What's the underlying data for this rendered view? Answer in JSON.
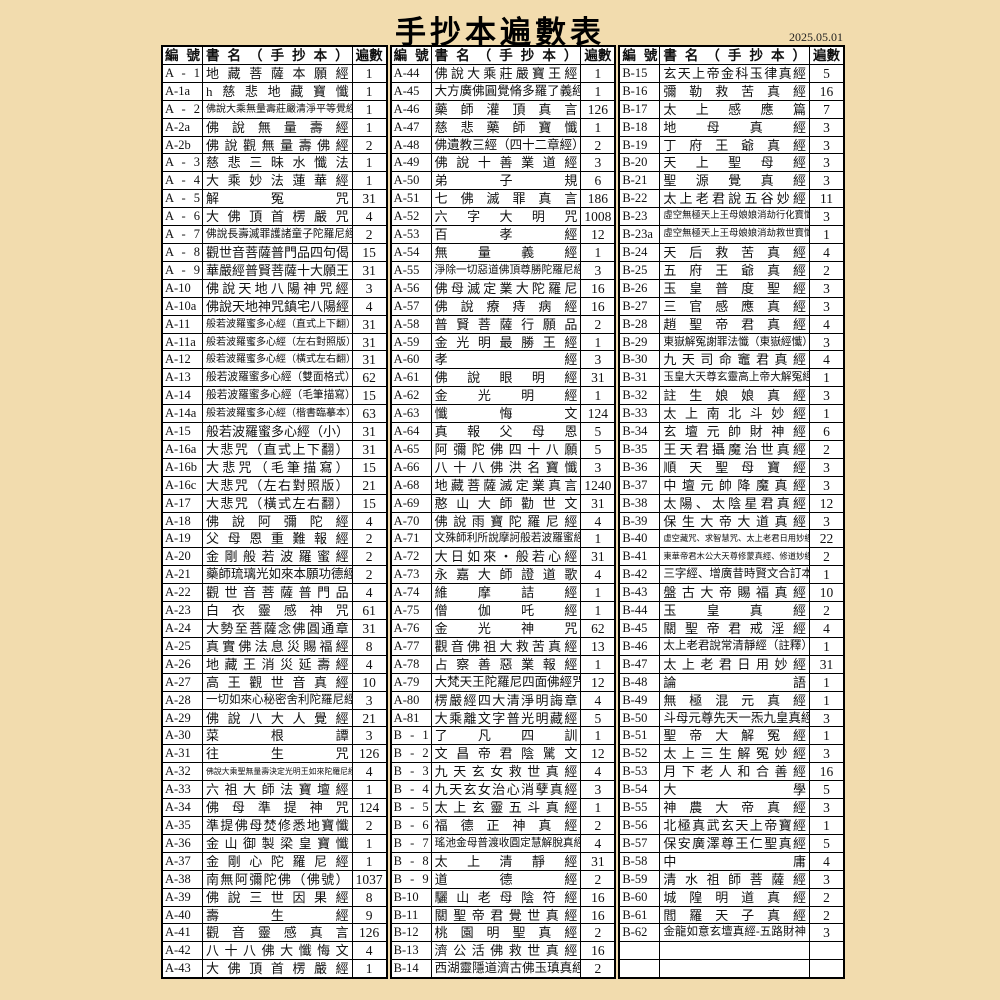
{
  "title": "手抄本遍數表",
  "date": "2025.05.01",
  "colors": {
    "background": "#f2dcae",
    "cell": "#ffffff",
    "border": "#000000",
    "text": "#111111"
  },
  "table": {
    "header": {
      "id": "編號",
      "title": "書名（手抄本）",
      "count": "遍數"
    },
    "columns": [
      {
        "rows": [
          {
            "id": "A - 1",
            "title": "地藏菩薩本願經",
            "count": "1"
          },
          {
            "id": "A-1a",
            "title": "h慈悲地藏寶懺",
            "count": "1"
          },
          {
            "id": "A - 2",
            "title": "佛說大乘無量壽莊嚴清淨平等覺經",
            "count": "1"
          },
          {
            "id": "A-2a",
            "title": "佛說無量壽經",
            "count": "1"
          },
          {
            "id": "A-2b",
            "title": "佛說觀無量壽佛經",
            "count": "2"
          },
          {
            "id": "A - 3",
            "title": "慈悲三昧水懺法",
            "count": "1"
          },
          {
            "id": "A - 4",
            "title": "大乘妙法蓮華經",
            "count": "1"
          },
          {
            "id": "A - 5",
            "title": "解冤咒",
            "count": "31"
          },
          {
            "id": "A - 6",
            "title": "大佛頂首楞嚴咒",
            "count": "4"
          },
          {
            "id": "A - 7",
            "title": "佛說長壽滅罪護諸童子陀羅尼經",
            "count": "2"
          },
          {
            "id": "A - 8",
            "title": "觀世音菩薩普門品四句偈",
            "count": "15"
          },
          {
            "id": "A - 9",
            "title": "華嚴經普賢菩薩十大願王",
            "count": "31"
          },
          {
            "id": "A-10",
            "title": "佛說天地八陽神咒經",
            "count": "3"
          },
          {
            "id": "A-10a",
            "title": "佛說天地神咒鎮宅八陽經",
            "count": "4"
          },
          {
            "id": "A-11",
            "title": "般若波羅蜜多心經（直式上下翻）",
            "count": "31"
          },
          {
            "id": "A-11a",
            "title": "般若波羅蜜多心經（左右對照版）",
            "count": "31"
          },
          {
            "id": "A-12",
            "title": "般若波羅蜜多心經（橫式左右翻）",
            "count": "31"
          },
          {
            "id": "A-13",
            "title": "般若波羅蜜多心經（雙面格式）",
            "count": "62"
          },
          {
            "id": "A-14",
            "title": "般若波羅蜜多心經（毛筆描寫）",
            "count": "15"
          },
          {
            "id": "A-14a",
            "title": "般若波羅蜜多心經（楷書臨摹本）",
            "count": "63"
          },
          {
            "id": "A-15",
            "title": "般若波羅蜜多心經（小）",
            "count": "31"
          },
          {
            "id": "A-16a",
            "title": "大悲咒（直式上下翻）",
            "count": "31"
          },
          {
            "id": "A-16b",
            "title": "大悲咒（毛筆描寫）",
            "count": "15"
          },
          {
            "id": "A-16c",
            "title": "大悲咒（左右對照版）",
            "count": "21"
          },
          {
            "id": "A-17",
            "title": "大悲咒（橫式左右翻）",
            "count": "15"
          },
          {
            "id": "A-18",
            "title": "佛說阿彌陀經",
            "count": "4"
          },
          {
            "id": "A-19",
            "title": "父母恩重難報經",
            "count": "2"
          },
          {
            "id": "A-20",
            "title": "金剛般若波羅蜜經",
            "count": "2"
          },
          {
            "id": "A-21",
            "title": "藥師琉璃光如來本願功德經",
            "count": "2"
          },
          {
            "id": "A-22",
            "title": "觀世音菩薩普門品",
            "count": "4"
          },
          {
            "id": "A-23",
            "title": "白衣靈感神咒",
            "count": "61"
          },
          {
            "id": "A-24",
            "title": "大勢至菩薩念佛圓通章",
            "count": "31"
          },
          {
            "id": "A-25",
            "title": "真實佛法息災賜福經",
            "count": "8"
          },
          {
            "id": "A-26",
            "title": "地藏王消災延壽經",
            "count": "4"
          },
          {
            "id": "A-27",
            "title": "高王觀世音真經",
            "count": "10"
          },
          {
            "id": "A-28",
            "title": "一切如來心秘密舍利陀羅尼經",
            "count": "3"
          },
          {
            "id": "A-29",
            "title": "佛說八大人覺經",
            "count": "21"
          },
          {
            "id": "A-30",
            "title": "菜根譚",
            "count": "3"
          },
          {
            "id": "A-31",
            "title": "往生咒",
            "count": "126"
          },
          {
            "id": "A-32",
            "title": "佛說大乘聖無量壽決定光明王如來陀羅尼經",
            "count": "4"
          },
          {
            "id": "A-33",
            "title": "六祖大師法寶壇經",
            "count": "1"
          },
          {
            "id": "A-34",
            "title": "佛母準提神咒",
            "count": "124"
          },
          {
            "id": "A-35",
            "title": "準提佛母焚修悉地寶懺",
            "count": "2"
          },
          {
            "id": "A-36",
            "title": "金山御製梁皇寶懺",
            "count": "1"
          },
          {
            "id": "A-37",
            "title": "金剛心陀羅尼經",
            "count": "1"
          },
          {
            "id": "A-38",
            "title": "南無阿彌陀佛（佛號）",
            "count": "1037"
          },
          {
            "id": "A-39",
            "title": "佛說三世因果經",
            "count": "8"
          },
          {
            "id": "A-40",
            "title": "壽生經",
            "count": "9"
          },
          {
            "id": "A-41",
            "title": "觀音靈感真言",
            "count": "126"
          },
          {
            "id": "A-42",
            "title": "八十八佛大懺悔文",
            "count": "4"
          },
          {
            "id": "A-43",
            "title": "大佛頂首楞嚴經",
            "count": "1"
          }
        ]
      },
      {
        "rows": [
          {
            "id": "A-44",
            "title": "佛說大乘莊嚴寶王經",
            "count": "1"
          },
          {
            "id": "A-45",
            "title": "大方廣佛圓覺脩多羅了義經",
            "count": "1"
          },
          {
            "id": "A-46",
            "title": "藥師灌頂真言",
            "count": "126"
          },
          {
            "id": "A-47",
            "title": "慈悲藥師寶懺",
            "count": "1"
          },
          {
            "id": "A-48",
            "title": "佛遺教三經（四十二章經）",
            "count": "2"
          },
          {
            "id": "A-49",
            "title": "佛說十善業道經",
            "count": "3"
          },
          {
            "id": "A-50",
            "title": "弟子規",
            "count": "6"
          },
          {
            "id": "A-51",
            "title": "七佛滅罪真言",
            "count": "186"
          },
          {
            "id": "A-52",
            "title": "六字大明咒",
            "count": "1008"
          },
          {
            "id": "A-53",
            "title": "百孝經",
            "count": "12"
          },
          {
            "id": "A-54",
            "title": "無量義經",
            "count": "1"
          },
          {
            "id": "A-55",
            "title": "淨除一切惡道佛頂尊勝陀羅尼經",
            "count": "3"
          },
          {
            "id": "A-56",
            "title": "佛母滅定業大陀羅尼",
            "count": "16"
          },
          {
            "id": "A-57",
            "title": "佛說療痔病經",
            "count": "16"
          },
          {
            "id": "A-58",
            "title": "普賢菩薩行願品",
            "count": "2"
          },
          {
            "id": "A-59",
            "title": "金光明最勝王經",
            "count": "1"
          },
          {
            "id": "A-60",
            "title": "孝經",
            "count": "3"
          },
          {
            "id": "A-61",
            "title": "佛說眼明經",
            "count": "31"
          },
          {
            "id": "A-62",
            "title": "金光明經",
            "count": "1"
          },
          {
            "id": "A-63",
            "title": "懺悔文",
            "count": "124"
          },
          {
            "id": "A-64",
            "title": "真報父母恩",
            "count": "5"
          },
          {
            "id": "A-65",
            "title": "阿彌陀佛四十八願",
            "count": "5"
          },
          {
            "id": "A-66",
            "title": "八十八佛洪名寶懺",
            "count": "3"
          },
          {
            "id": "A-68",
            "title": "地藏菩薩滅定業真言",
            "count": "1240"
          },
          {
            "id": "A-69",
            "title": "憨山大師勸世文",
            "count": "31"
          },
          {
            "id": "A-70",
            "title": "佛說雨寶陀羅尼經",
            "count": "4"
          },
          {
            "id": "A-71",
            "title": "文殊師利所說摩訶般若波羅蜜經",
            "count": "1"
          },
          {
            "id": "A-72",
            "title": "大日如來・般若心經",
            "count": "31"
          },
          {
            "id": "A-73",
            "title": "永嘉大師證道歌",
            "count": "4"
          },
          {
            "id": "A-74",
            "title": "維摩詰經",
            "count": "1"
          },
          {
            "id": "A-75",
            "title": "僧伽吒經",
            "count": "1"
          },
          {
            "id": "A-76",
            "title": "金光神咒",
            "count": "62"
          },
          {
            "id": "A-77",
            "title": "觀音佛祖大救苦真經",
            "count": "13"
          },
          {
            "id": "A-78",
            "title": "占察善惡業報經",
            "count": "1"
          },
          {
            "id": "A-79",
            "title": "大梵天王陀羅尼四面佛經咒",
            "count": "12"
          },
          {
            "id": "A-80",
            "title": "楞嚴經四大清淨明誨章",
            "count": "4"
          },
          {
            "id": "A-81",
            "title": "大乘離文字普光明藏經",
            "count": "5"
          },
          {
            "id": "B - 1",
            "title": "了凡四訓",
            "count": "1"
          },
          {
            "id": "B - 2",
            "title": "文昌帝君陰騭文",
            "count": "12"
          },
          {
            "id": "B - 3",
            "title": "九天玄女救世真經",
            "count": "4"
          },
          {
            "id": "B - 4",
            "title": "九天玄女治心消孽真經",
            "count": "3"
          },
          {
            "id": "B - 5",
            "title": "太上玄靈五斗真經",
            "count": "1"
          },
          {
            "id": "B - 6",
            "title": "福德正神真經",
            "count": "2"
          },
          {
            "id": "B - 7",
            "title": "瑤池金母普渡收圓定慧解脫真經",
            "count": "4"
          },
          {
            "id": "B - 8",
            "title": "太上清靜經",
            "count": "31"
          },
          {
            "id": "B - 9",
            "title": "道德經",
            "count": "2"
          },
          {
            "id": "B-10",
            "title": "驪山老母陰符經",
            "count": "16"
          },
          {
            "id": "B-11",
            "title": "關聖帝君覺世真經",
            "count": "16"
          },
          {
            "id": "B-12",
            "title": "桃園明聖真經",
            "count": "2"
          },
          {
            "id": "B-13",
            "title": "濟公活佛救世真經",
            "count": "16"
          },
          {
            "id": "B-14",
            "title": "西湖靈隱道濟古佛玉瑱真經",
            "count": "2"
          }
        ]
      },
      {
        "rows": [
          {
            "id": "B-15",
            "title": "玄天上帝金科玉律真經",
            "count": "5"
          },
          {
            "id": "B-16",
            "title": "彌勒救苦真經",
            "count": "16"
          },
          {
            "id": "B-17",
            "title": "太上感應篇",
            "count": "7"
          },
          {
            "id": "B-18",
            "title": "地母真經",
            "count": "3"
          },
          {
            "id": "B-19",
            "title": "丁府王爺真經",
            "count": "3"
          },
          {
            "id": "B-20",
            "title": "天上聖母經",
            "count": "3"
          },
          {
            "id": "B-21",
            "title": "聖源覺真經",
            "count": "3"
          },
          {
            "id": "B-22",
            "title": "太上老君說五谷妙經",
            "count": "11"
          },
          {
            "id": "B-23",
            "title": "虛空無極天上王母娘娘消劫行化寶懺",
            "count": "3"
          },
          {
            "id": "B-23a",
            "title": "虛空無極天上王母娘娘消劫救世寶懺",
            "count": "1"
          },
          {
            "id": "B-24",
            "title": "天后救苦真經",
            "count": "4"
          },
          {
            "id": "B-25",
            "title": "五府王爺真經",
            "count": "2"
          },
          {
            "id": "B-26",
            "title": "玉皇普度聖經",
            "count": "3"
          },
          {
            "id": "B-27",
            "title": "三官感應真經",
            "count": "3"
          },
          {
            "id": "B-28",
            "title": "趙聖帝君真經",
            "count": "4"
          },
          {
            "id": "B-29",
            "title": "東嶽解冤謝罪法懺（東嶽經懺）",
            "count": "3"
          },
          {
            "id": "B-30",
            "title": "九天司命竈君真經",
            "count": "4"
          },
          {
            "id": "B-31",
            "title": "玉皇大天尊玄靈高上帝大解冤經",
            "count": "1"
          },
          {
            "id": "B-32",
            "title": "註生娘娘真經",
            "count": "3"
          },
          {
            "id": "B-33",
            "title": "太上南北斗妙經",
            "count": "1"
          },
          {
            "id": "B-34",
            "title": "玄壇元帥財神經",
            "count": "6"
          },
          {
            "id": "B-35",
            "title": "王天君攝魔治世真經",
            "count": "2"
          },
          {
            "id": "B-36",
            "title": "順天聖母寶經",
            "count": "3"
          },
          {
            "id": "B-37",
            "title": "中壇元帥降魔真經",
            "count": "3"
          },
          {
            "id": "B-38",
            "title": "太陽、太陰星君真經",
            "count": "12"
          },
          {
            "id": "B-39",
            "title": "保生大帝大道真經",
            "count": "3"
          },
          {
            "id": "B-40",
            "title": "虛空藏咒、求智慧咒、太上老君日用妙經",
            "count": "22"
          },
          {
            "id": "B-41",
            "title": "東華帝君木公大天尊修蒙真經、修道妙經",
            "count": "2"
          },
          {
            "id": "B-42",
            "title": "三字經、增廣昔時賢文合訂本",
            "count": "1"
          },
          {
            "id": "B-43",
            "title": "盤古大帝賜福真經",
            "count": "10"
          },
          {
            "id": "B-44",
            "title": "玉皇真經",
            "count": "2"
          },
          {
            "id": "B-45",
            "title": "關聖帝君戒淫經",
            "count": "4"
          },
          {
            "id": "B-46",
            "title": "太上老君說常清靜經（註釋）",
            "count": "1"
          },
          {
            "id": "B-47",
            "title": "太上老君日用妙經",
            "count": "31"
          },
          {
            "id": "B-48",
            "title": "論語",
            "count": "1"
          },
          {
            "id": "B-49",
            "title": "無極混元真經",
            "count": "1"
          },
          {
            "id": "B-50",
            "title": "斗母元尊先天一炁九皇真經",
            "count": "3"
          },
          {
            "id": "B-51",
            "title": "聖帝大解冤經",
            "count": "1"
          },
          {
            "id": "B-52",
            "title": "太上三生解冤妙經",
            "count": "3"
          },
          {
            "id": "B-53",
            "title": "月下老人和合善經",
            "count": "16"
          },
          {
            "id": "B-54",
            "title": "大學",
            "count": "5"
          },
          {
            "id": "B-55",
            "title": "神農大帝真經",
            "count": "3"
          },
          {
            "id": "B-56",
            "title": "北極真武玄天上帝寶經",
            "count": "1"
          },
          {
            "id": "B-57",
            "title": "保安廣澤尊王仁聖真經",
            "count": "5"
          },
          {
            "id": "B-58",
            "title": "中庸",
            "count": "4"
          },
          {
            "id": "B-59",
            "title": "清水祖師菩薩經",
            "count": "3"
          },
          {
            "id": "B-60",
            "title": "城隍明道真經",
            "count": "2"
          },
          {
            "id": "B-61",
            "title": "閻羅天子真經",
            "count": "2"
          },
          {
            "id": "B-62",
            "title": "金龍如意玄壇真經-五路財神",
            "count": "3"
          },
          {
            "id": "",
            "title": "",
            "count": ""
          },
          {
            "id": "",
            "title": "",
            "count": ""
          }
        ]
      }
    ]
  }
}
